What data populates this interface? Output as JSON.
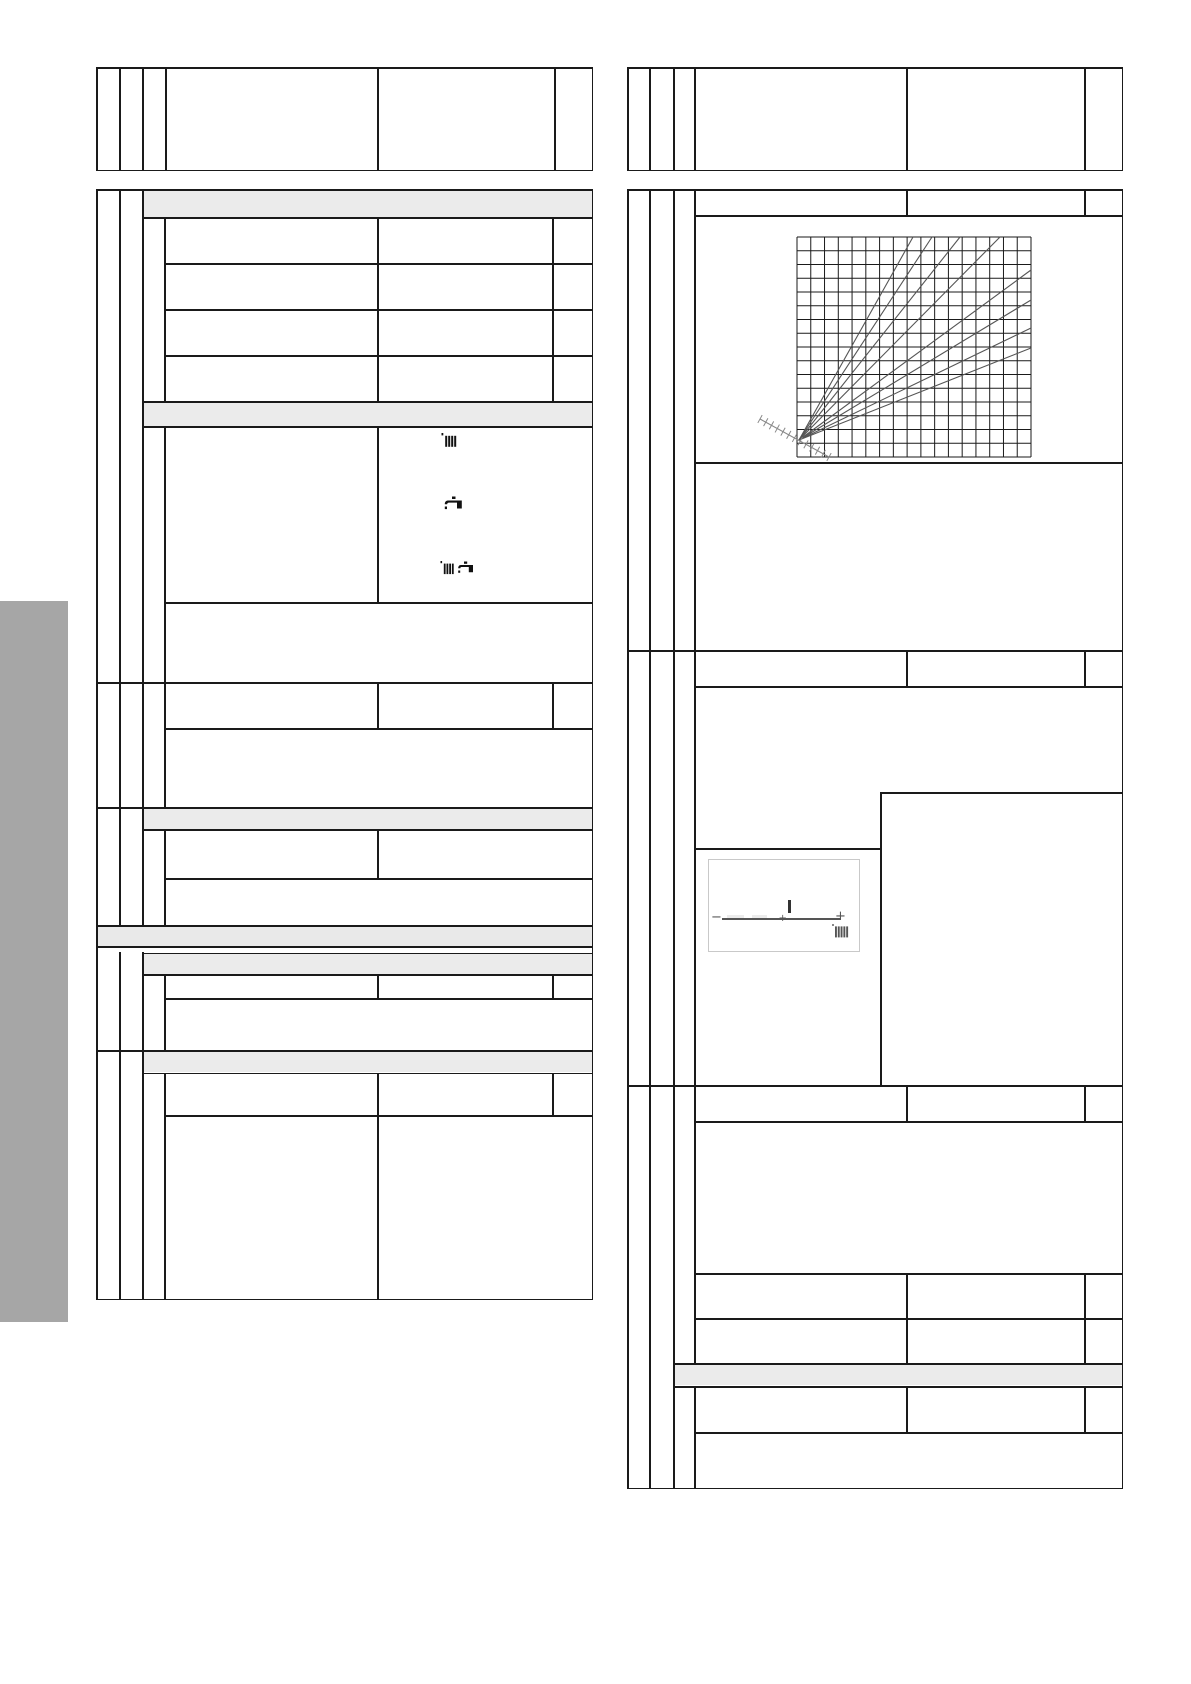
{
  "document": {
    "kind": "manual-page-with-empty-tables",
    "visible_text": "none — all table cells are empty; only borders, shaded section bands, icons and diagrams are rendered"
  },
  "colors": {
    "page_bg": "#ffffff",
    "table_border": "#1a1a1a",
    "section_band": "#ebebeb",
    "sidebar_tab": "#a6a6a6",
    "chart_grid": "#1a1a1a",
    "chart_ray": "#555555",
    "hatch_axis": "#888888",
    "diagram_border": "#c9c9c9",
    "diagram_line": "#555555",
    "icon_color": "#111111"
  },
  "sidebar_tab": {
    "x": 0,
    "y": 601,
    "width": 68,
    "height": 721
  },
  "icons": {
    "heating_icon": "radiator",
    "hot_water_icon": "tap",
    "heating_and_hot_water_icon": "radiator-and-tap",
    "display_corner_icon": "radiator"
  },
  "display_diagram": {
    "minus_label": "−",
    "plus_label": "+",
    "center_tick": "+",
    "cursor": "vertical-bar-above-scale-line",
    "bottom_right_icon": "radiator",
    "description": "small framed display screen showing a horizontal adjustment scale from − to + with a cursor right of centre and a radiator symbol at bottom right"
  },
  "chart_data": {
    "type": "line",
    "title": "",
    "xlabel": "",
    "ylabel": "",
    "tick_labels": "none visible",
    "legend": "none visible",
    "description": "fan of 8 unlabeled curves (heating curves) radiating from a common origin near the lower-left corner of a square grid; a hatched diagonal reference axis passes through the origin",
    "grid": {
      "cols": 17,
      "rows": 16,
      "x": 797,
      "y": 237,
      "width": 234,
      "height": 220
    },
    "origin": {
      "x": 799,
      "y": 440
    },
    "rays": [
      [
        913,
        237
      ],
      [
        932,
        237
      ],
      [
        960,
        237
      ],
      [
        1000,
        237
      ],
      [
        1031,
        270
      ],
      [
        1031,
        300
      ],
      [
        1031,
        328
      ],
      [
        1031,
        348
      ]
    ],
    "hatch_axis": {
      "x1": 760,
      "y1": 419,
      "x2": 829,
      "y2": 457,
      "ticks": 12,
      "tick_len": 4.5
    }
  }
}
